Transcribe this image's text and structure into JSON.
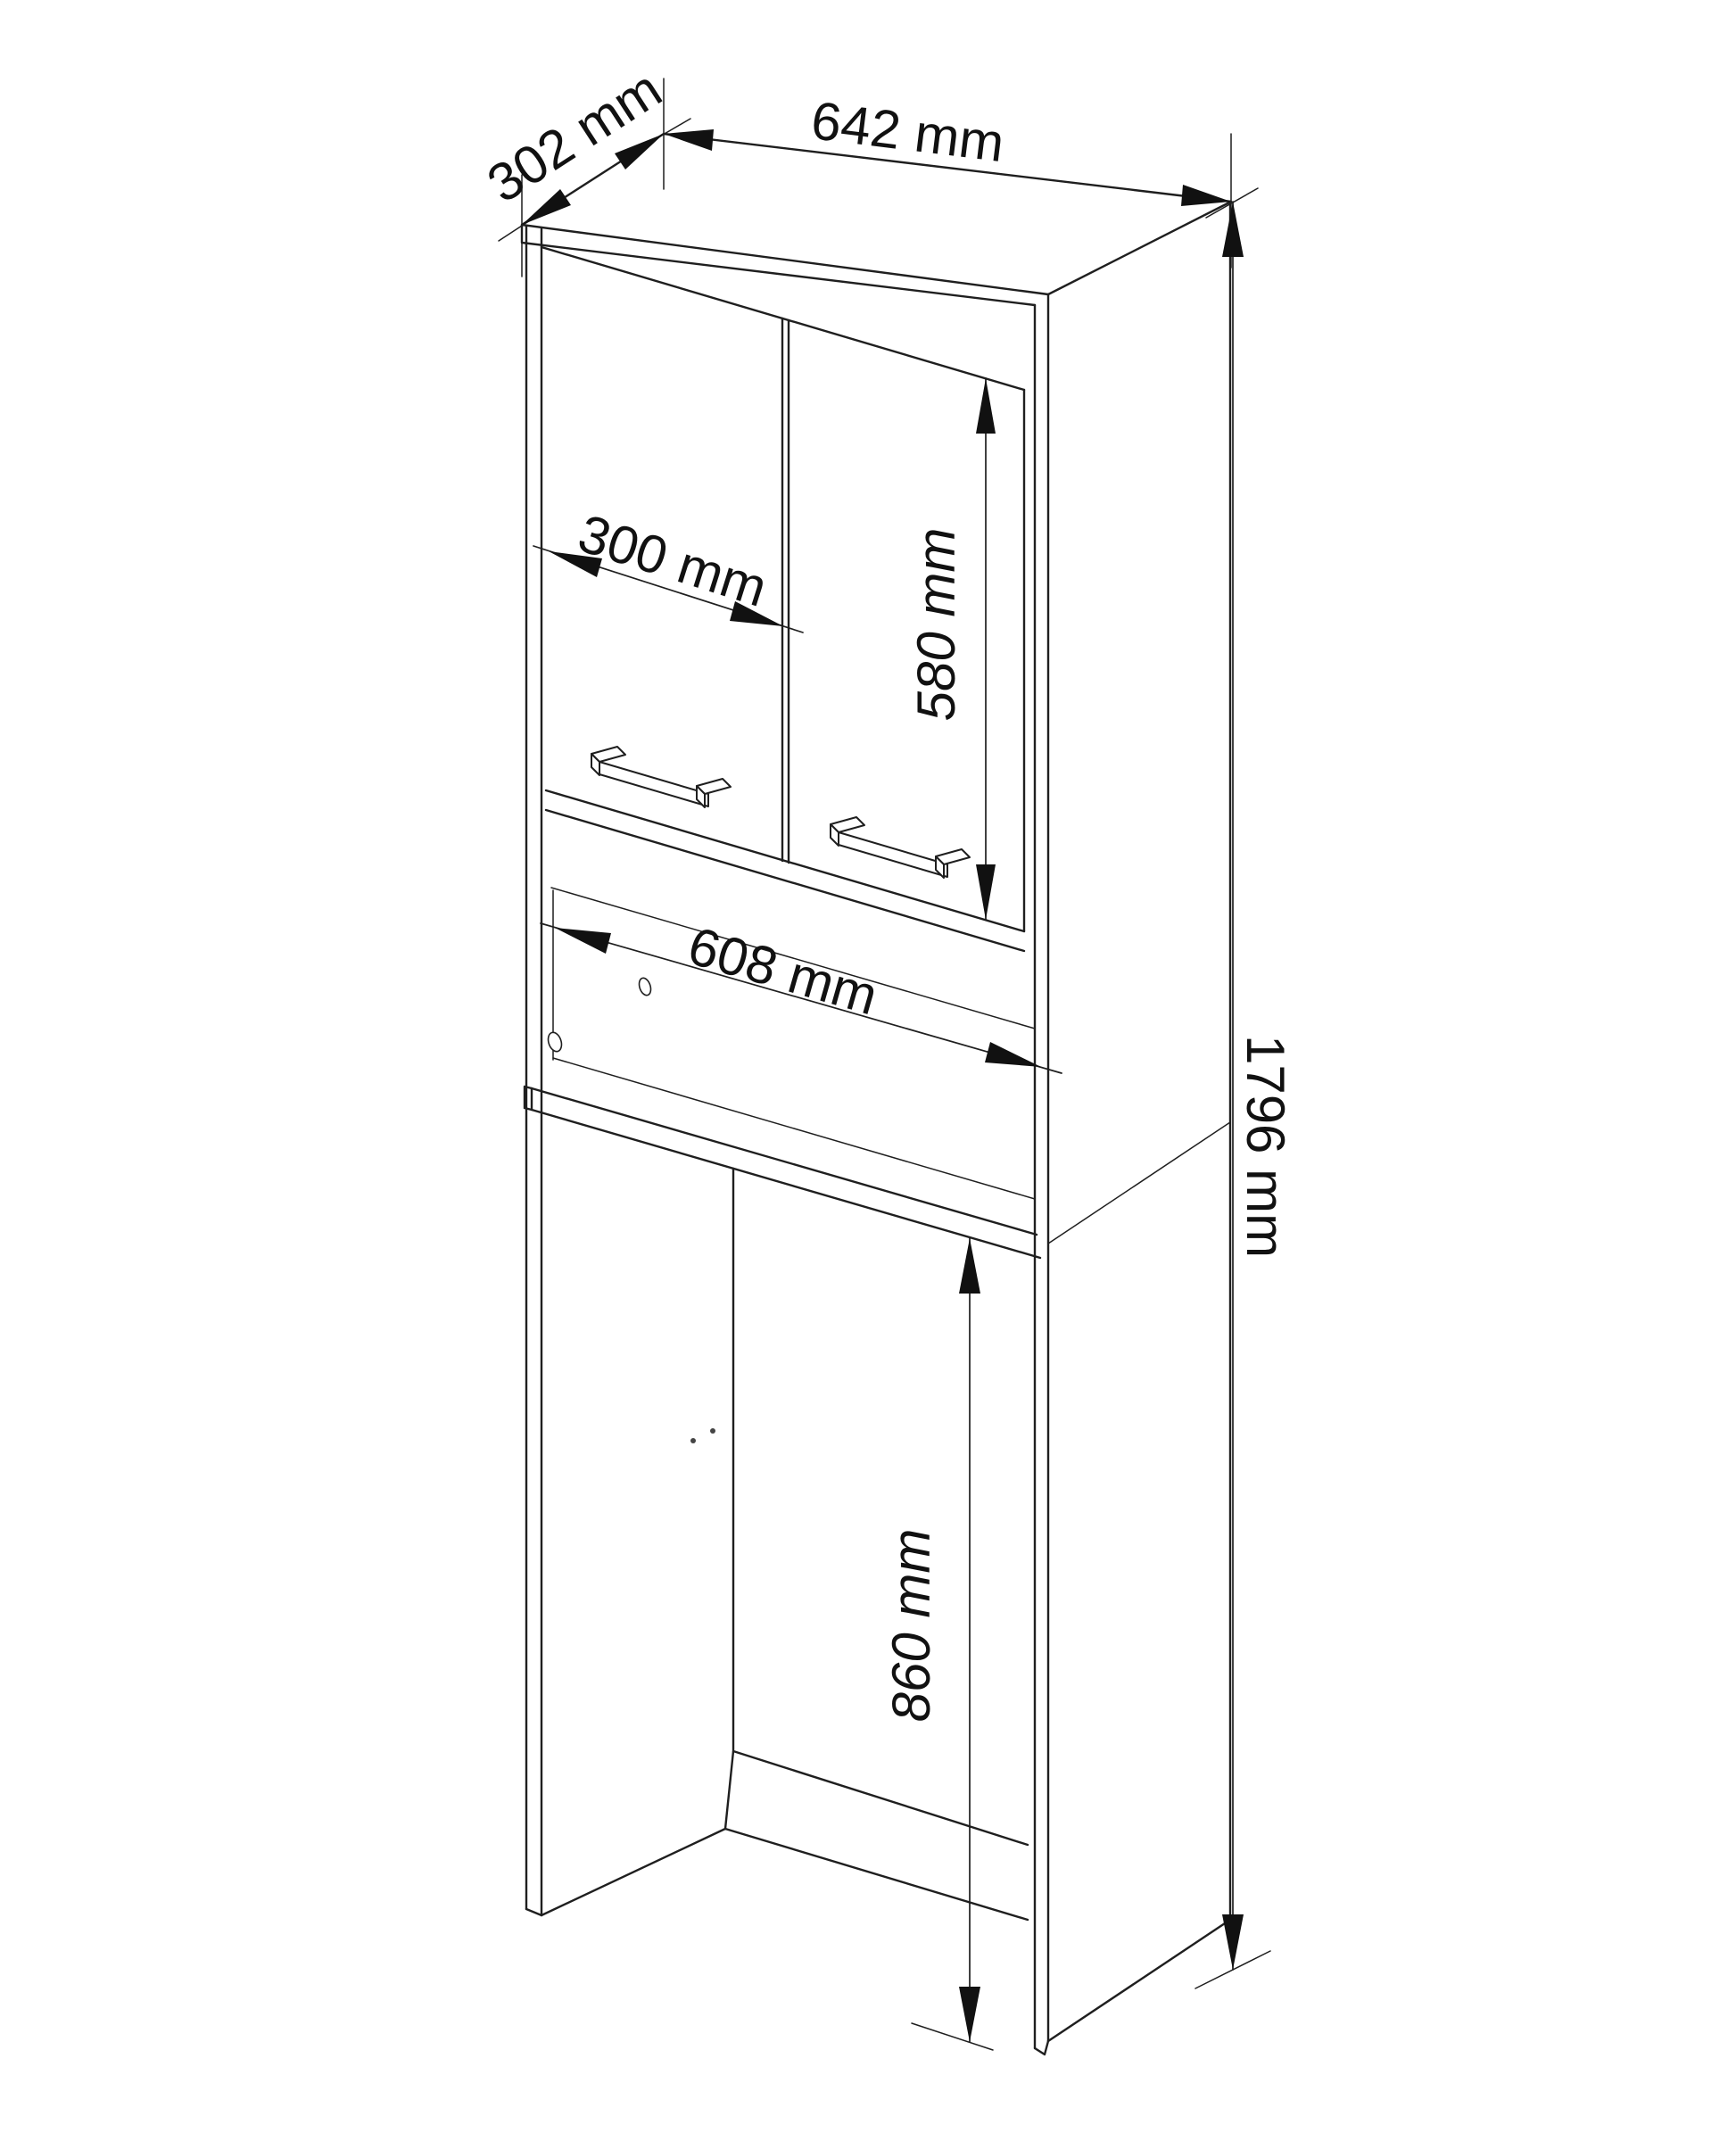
{
  "drawing": {
    "type": "furniture-dimension-diagram",
    "subject": "tall bathroom cabinet over washing machine, isometric line drawing",
    "unit": "mm",
    "background_color": "#ffffff",
    "line_color": "#1f1f1f",
    "text_color": "#111111",
    "labels": {
      "top_depth": "302 mm",
      "top_width": "642 mm",
      "door_width": "300 mm",
      "door_height": "580 mm",
      "niche_width": "608 mm",
      "total_height": "1796 mm",
      "washer_space_height": "860 mm"
    },
    "values": {
      "top_depth": 302,
      "top_width": 642,
      "door_width": 300,
      "door_height": 580,
      "niche_width": 608,
      "total_height": 1796,
      "washer_space_height": 860
    }
  }
}
